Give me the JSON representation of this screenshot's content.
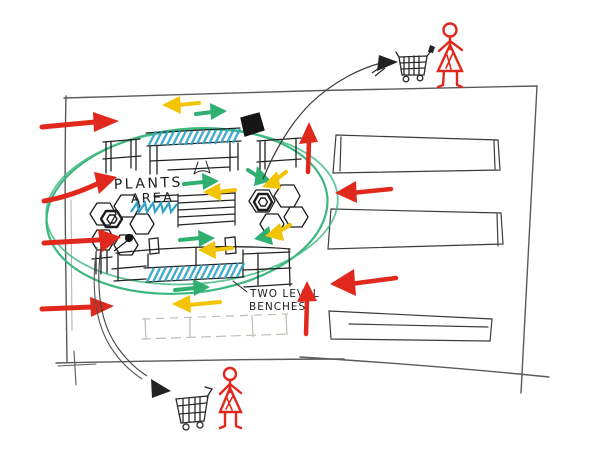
{
  "sketch": {
    "labels": {
      "plants_line1": "PLANTS",
      "plants_line2": "AREA",
      "benches_line1": "TWO LEVEL",
      "benches_line2": "BENCHES"
    },
    "icons": {
      "top_right": [
        "shopping-cart-icon",
        "person-icon"
      ],
      "bottom_left": [
        "shopping-cart-icon",
        "person-icon"
      ]
    },
    "palette": {
      "marker_red": "#e0281c",
      "marker_green": "#2fb070",
      "marker_yellow": "#f2c402",
      "marker_teal": "#2fa3c7",
      "ink": "#1e1e1e",
      "pencil": "#8e8880"
    }
  }
}
